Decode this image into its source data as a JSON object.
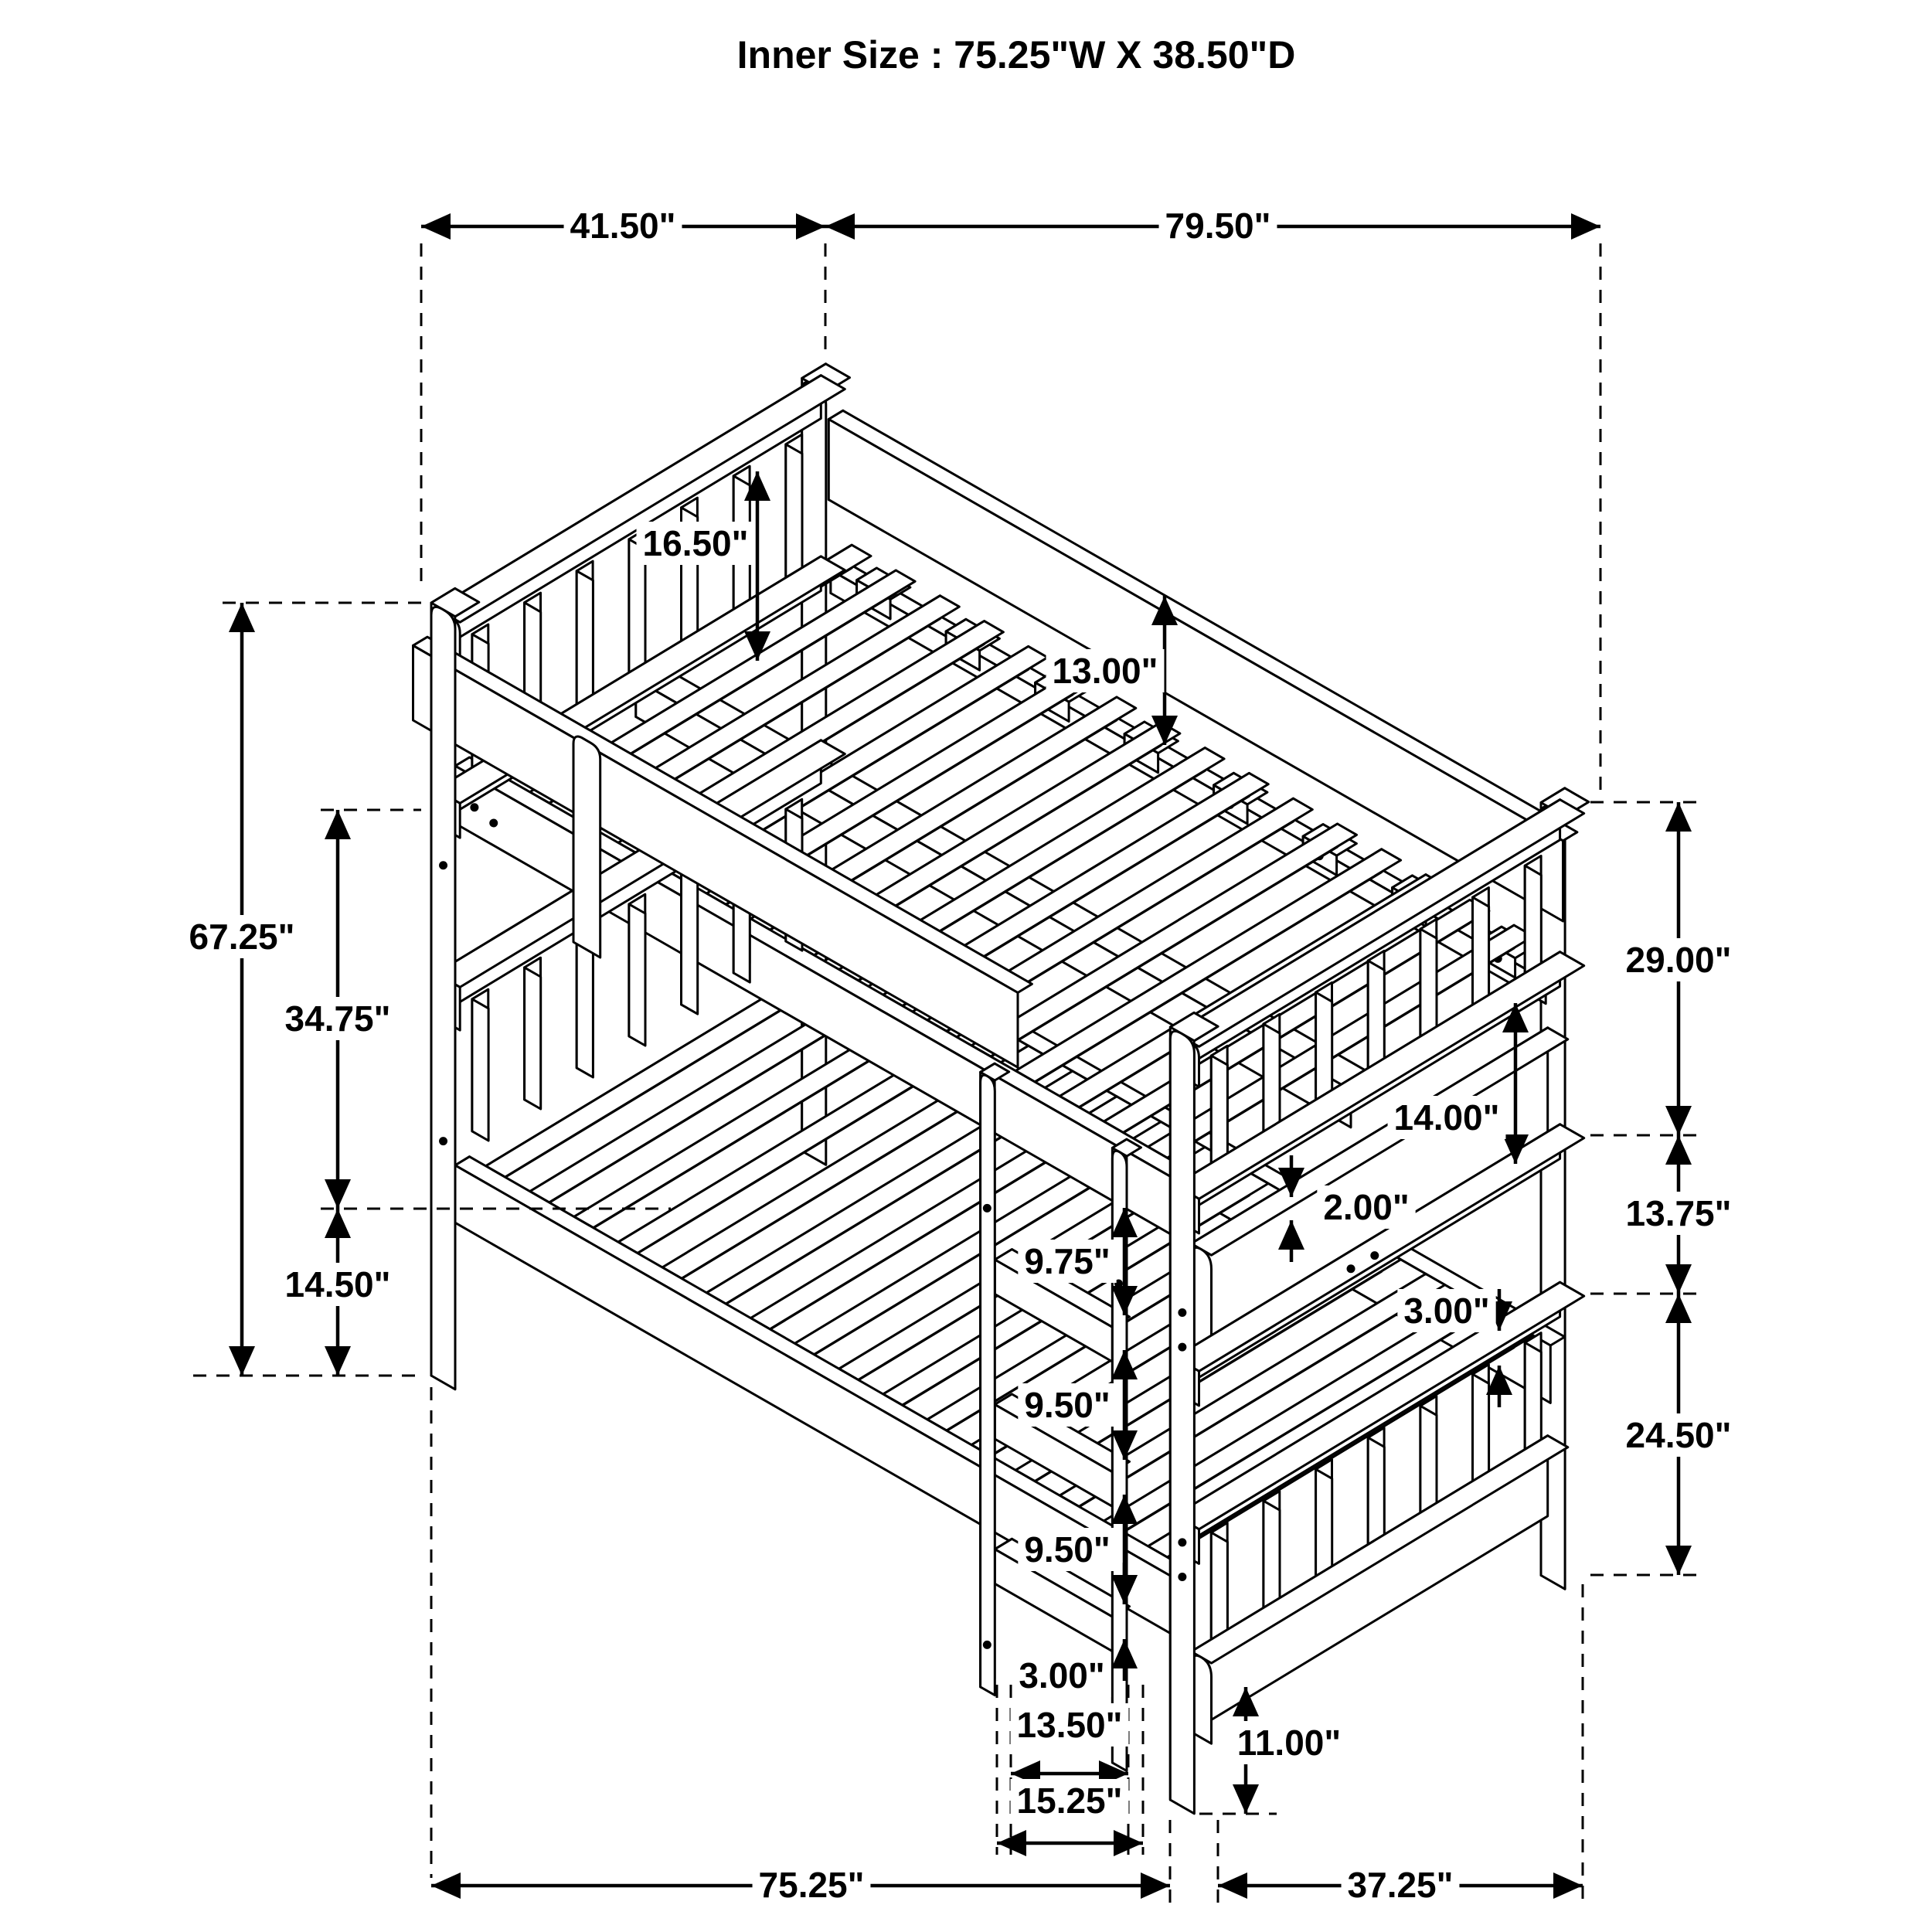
{
  "title": "Inner Size : 75.25\"W X  38.50\"D",
  "dimensions": {
    "top_width_left": "41.50\"",
    "top_width_right": "79.50\"",
    "total_height": "67.25\"",
    "upper_rail_height": "34.75\"",
    "lower_rail_height": "14.50\"",
    "headboard_above_deck": "16.50\"",
    "back_rail_above_deck": "13.00\"",
    "right_upper": "29.00\"",
    "right_middle": "13.75\"",
    "right_lower": "24.50\"",
    "guard_rail_gap": "14.00\"",
    "slat_thickness": "2.00\"",
    "footboard_rail_thickness": "3.00\"",
    "ladder_gap_top": "9.75\"",
    "ladder_gap_mid": "9.50\"",
    "ladder_gap_lower": "9.50\"",
    "ladder_rung_thickness": "3.00\"",
    "ladder_inner_width": "13.50\"",
    "ladder_outer_width": "15.25\"",
    "floor_clearance": "11.00\"",
    "bottom_length": "75.25\"",
    "bottom_depth": "37.25\""
  }
}
